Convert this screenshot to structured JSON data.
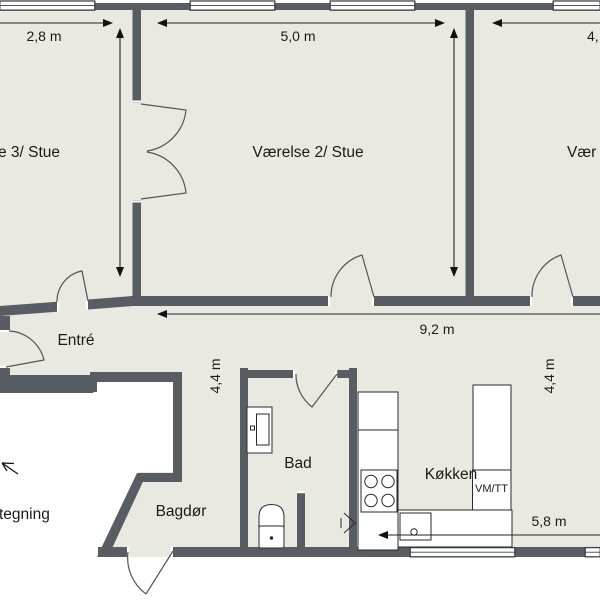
{
  "title": "Plantegning (floor plan)",
  "colors": {
    "wall": "#585d64",
    "floor": "#e9e9e2",
    "outside": "#ffffff",
    "line": "#222222",
    "fixture_stroke": "#2a2a2a",
    "door_arc": "#555555"
  },
  "rooms": {
    "vaerelse3": {
      "label": "e 3/ Stue"
    },
    "vaerelse2": {
      "label": "Værelse 2/ Stue"
    },
    "vaerelse1": {
      "label": "Vær"
    },
    "entre": {
      "label": "Entré"
    },
    "bad": {
      "label": "Bad"
    },
    "bagdoer": {
      "label": "Bagdør"
    },
    "koekken": {
      "label": "Køkken"
    }
  },
  "appliances": {
    "washer_dryer": {
      "label": "VM/TT"
    }
  },
  "dimensions": {
    "top_left": {
      "label": "2,8 m"
    },
    "top_middle": {
      "label": "5,0 m"
    },
    "top_right": {
      "label": "4,"
    },
    "left_vertical": {
      "label": "4,4 m"
    },
    "right_vertical": {
      "label": "4,4 m"
    },
    "hallway": {
      "label": "9,2 m"
    },
    "kitchen": {
      "label": "5,8 m"
    }
  },
  "annotation": {
    "label": "tegning"
  }
}
